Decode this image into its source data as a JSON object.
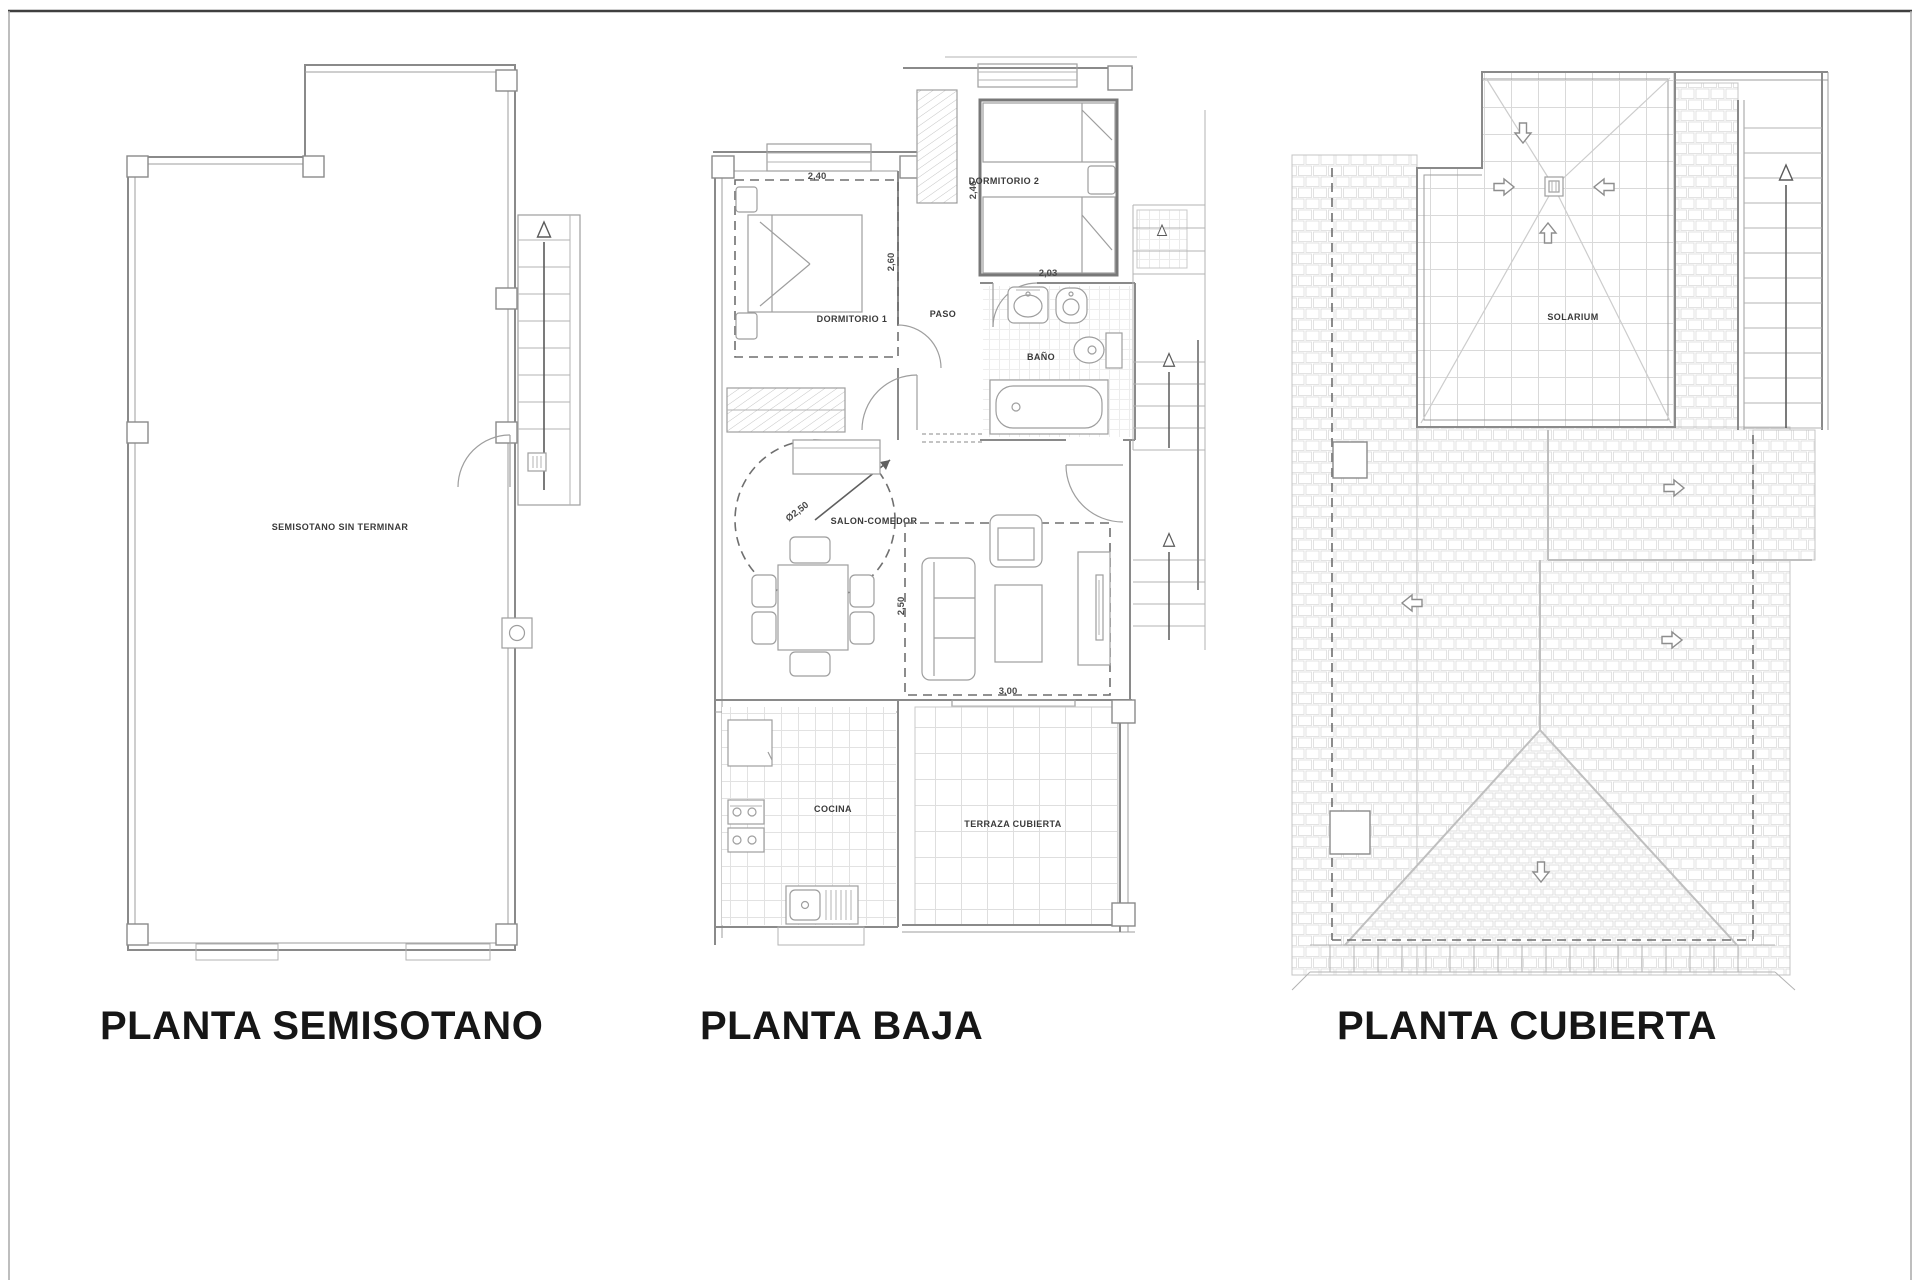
{
  "sheet": {
    "type": "architectural-floor-plans",
    "background": "#ffffff",
    "line_color": "#8a8a8a",
    "label_color": "#3a3a3a",
    "title_color": "#161616"
  },
  "titles": {
    "semisotano": "PLANTA SEMISOTANO",
    "baja": "PLANTA BAJA",
    "cubierta": "PLANTA CUBIERTA"
  },
  "labels": {
    "semisotano_room": "SEMISOTANO SIN TERMINAR",
    "dormitorio1": "DORMITORIO 1",
    "dormitorio2": "DORMITORIO 2",
    "paso": "PASO",
    "bano": "BAÑO",
    "salon": "SALON-COMEDOR",
    "cocina": "COCINA",
    "terraza": "TERRAZA CUBIERTA",
    "solarium": "SOLARIUM"
  },
  "dimensions": {
    "dorm1_w": "2,40",
    "dorm1_h": "2,60",
    "dorm2_w": "2,03",
    "dorm2_h": "2,46",
    "salon_circle": "Ø2,50",
    "salon_h": "2,50",
    "salon_w": "3,00"
  },
  "icons": {
    "stair_direction": "up-arrow-icon",
    "roof_slope": "slope-arrow-icon",
    "solarium_drain": "drain-icon"
  }
}
